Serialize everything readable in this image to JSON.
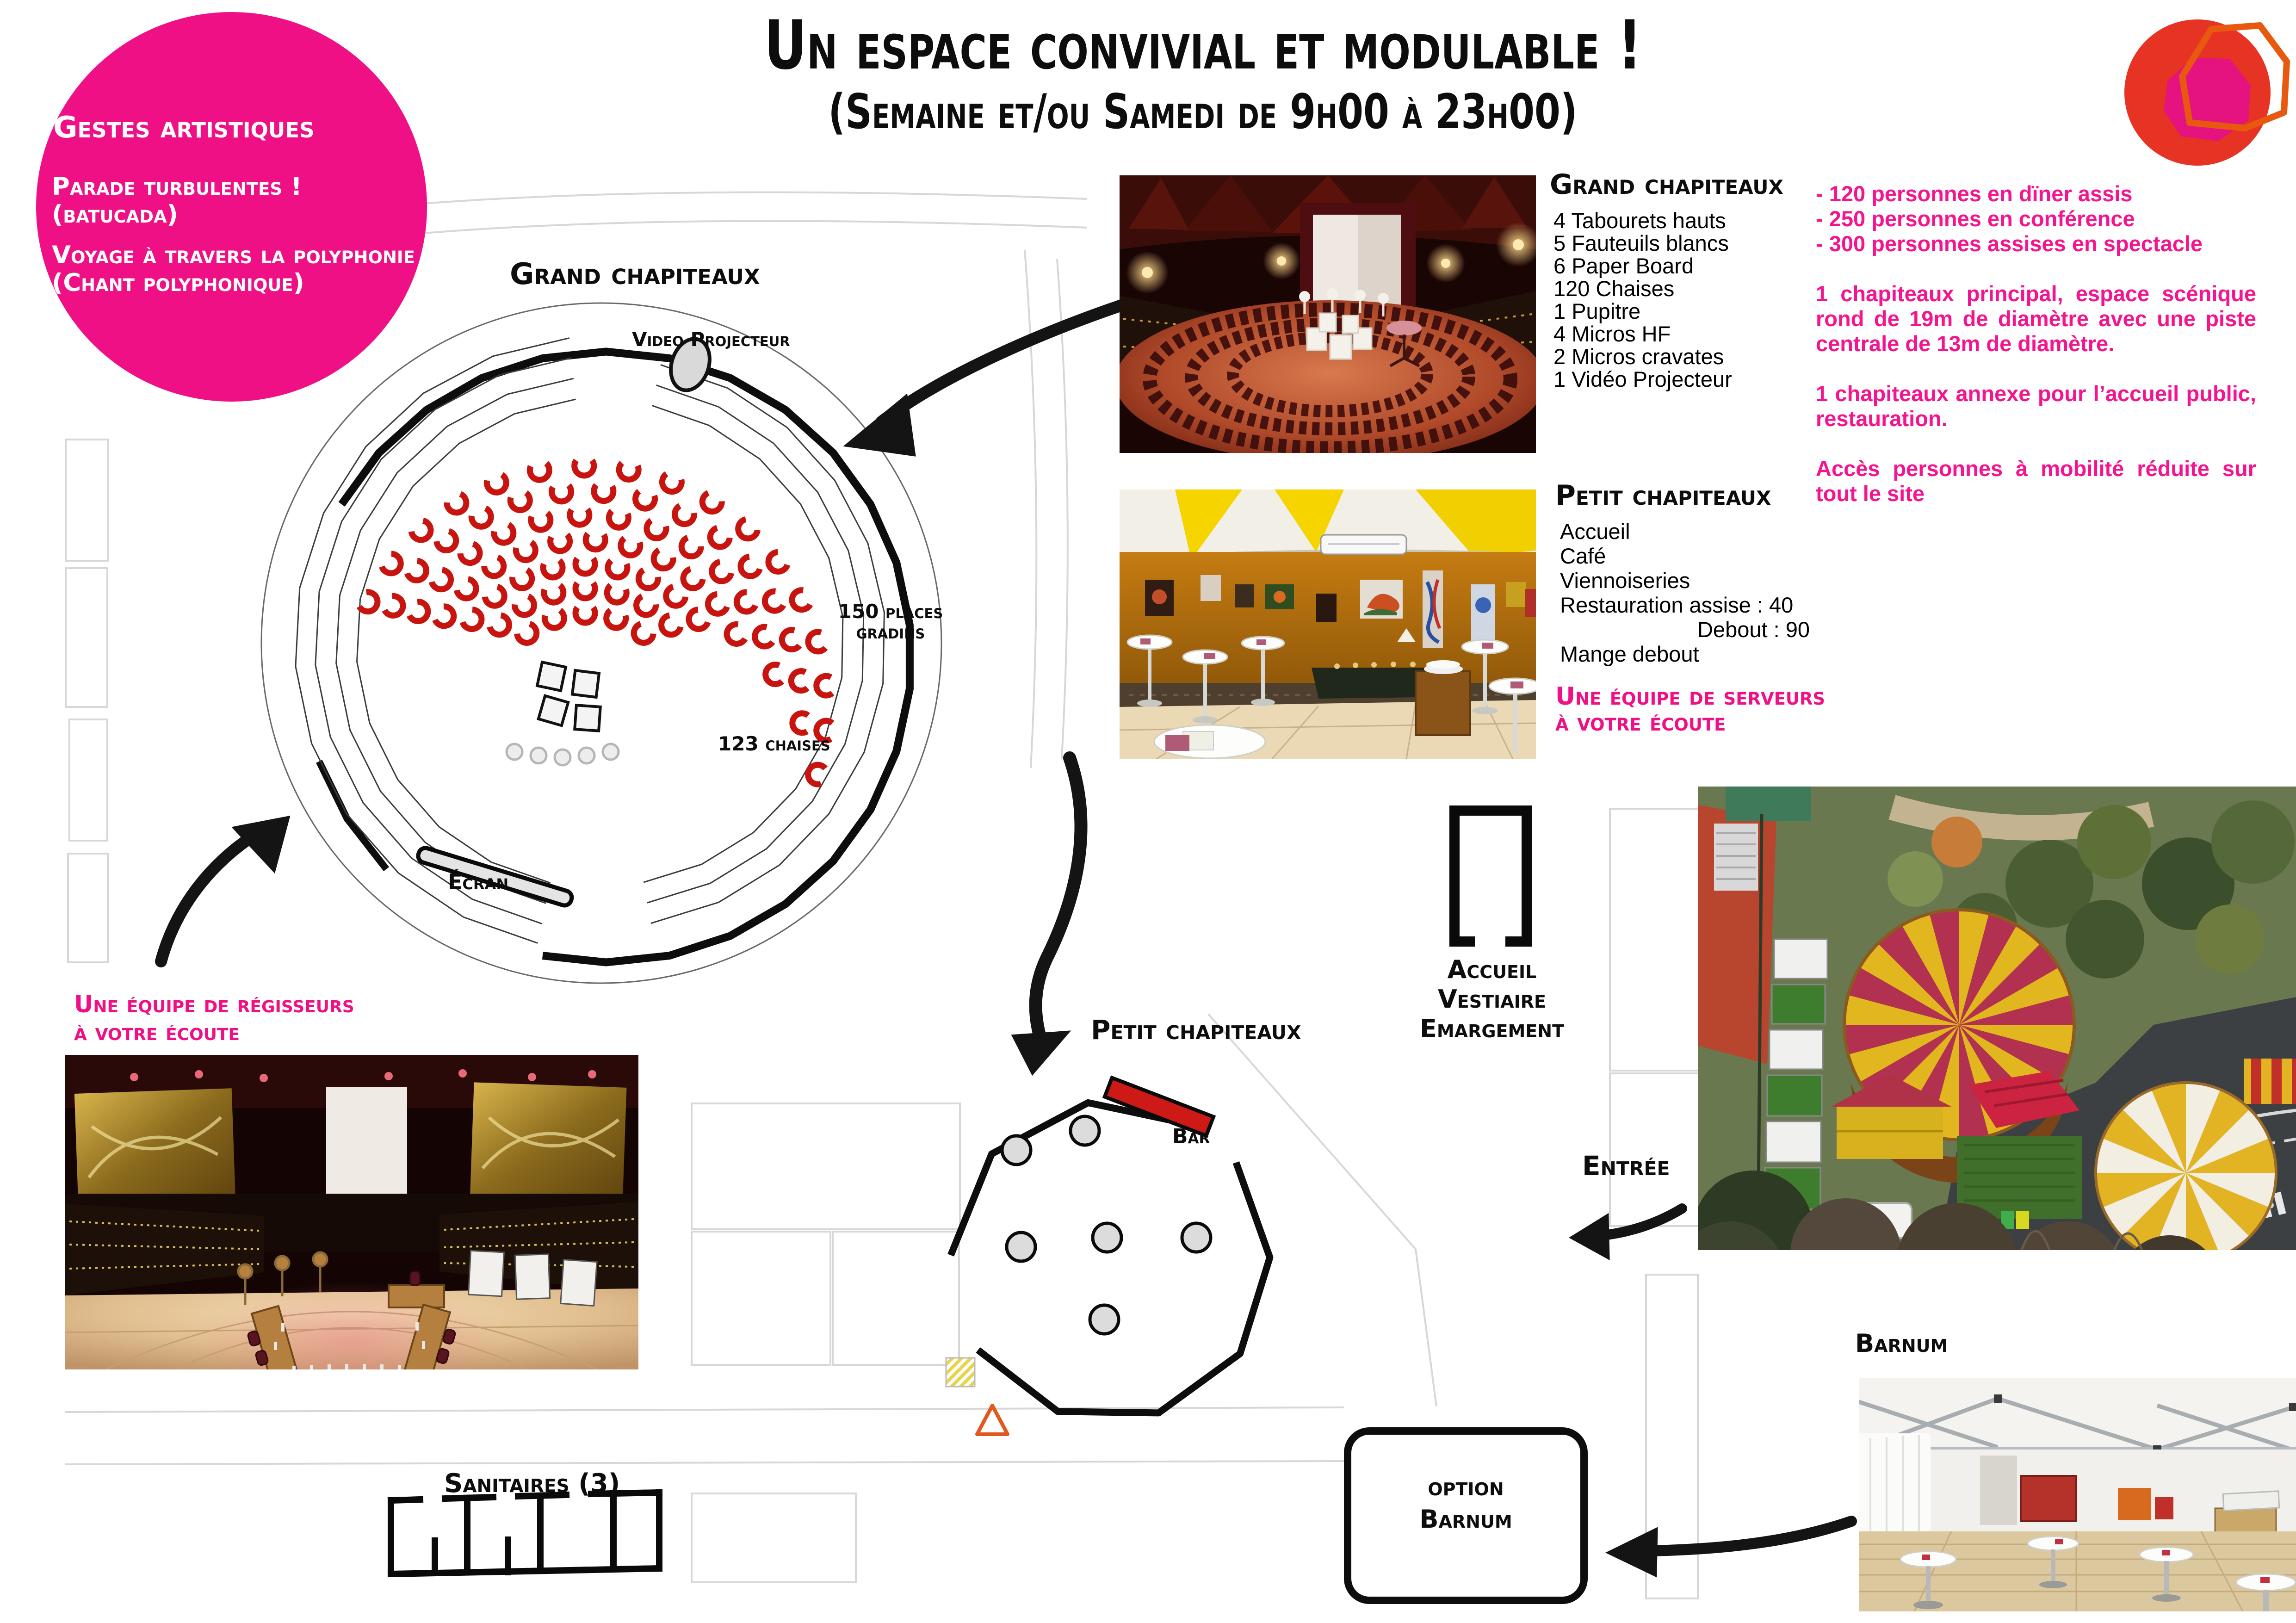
{
  "header": {
    "title": "Un espace convivial et modulable !",
    "subtitle": "(Semaine et/ou Samedi de 9h00 à 23h00)"
  },
  "badge": {
    "title": "Gestes artistiques",
    "lines": [
      "Parade turbulentes !",
      "(batucada)",
      "Voyage à travers la polyphonie",
      "(Chant polyphonique)"
    ]
  },
  "grand_plan": {
    "label": "Grand chapiteaux",
    "video": "Video Projecteur",
    "gradins1": "150 places",
    "gradins2": "gradins",
    "chaises": "123 chaises",
    "ecran": "Écran"
  },
  "grand_list": {
    "title": "Grand chapiteaux",
    "items": [
      "4 Tabourets hauts",
      "5 Fauteuils blancs",
      "6 Paper Board",
      "120 Chaises",
      "1 Pupitre",
      "4 Micros HF",
      "2 Micros cravates",
      "1 Vidéo Projecteur"
    ]
  },
  "capacity": {
    "bullets": [
      "- 120 personnes en dïner assis",
      "- 250 personnes en conférence",
      "- 300 personnes assises en spectacle"
    ],
    "paragraphs": [
      "1 chapiteaux principal, espace scénique rond de 19m de diamètre avec une piste centrale de 13m de diamètre.",
      "1 chapiteaux annexe pour l’accueil public, restauration.",
      "Accès personnes à mobilité réduite sur tout le site"
    ]
  },
  "petit_list": {
    "title": "Petit chapiteaux",
    "items": [
      "Accueil",
      "Café",
      "Viennoiseries",
      "Restauration assise : 40"
    ],
    "debout": "Debout : 90",
    "mange": "Mange debout",
    "team1": "Une équipe de serveurs",
    "team2": "à votre écoute"
  },
  "regisseurs": {
    "line1": "Une équipe de régisseurs",
    "line2": "à votre écoute"
  },
  "petit_plan": {
    "label": "Petit chapiteaux",
    "bar": "Bar"
  },
  "accueil": {
    "lines": [
      "Accueil",
      "Vestiaire",
      "Emargement"
    ]
  },
  "entree": {
    "label": "Entrée"
  },
  "barnum": {
    "label": "Barnum",
    "option1": "option",
    "option2": "Barnum"
  },
  "sanitaires": {
    "label": "Sanitaires (3)"
  },
  "colors": {
    "pink": "#ef1086",
    "seat_red": "#c8140e",
    "bar_red": "#ce1a17",
    "logo_red": "#e63323",
    "logo_pink": "#e5137f",
    "logo_orange": "#e8590f"
  }
}
